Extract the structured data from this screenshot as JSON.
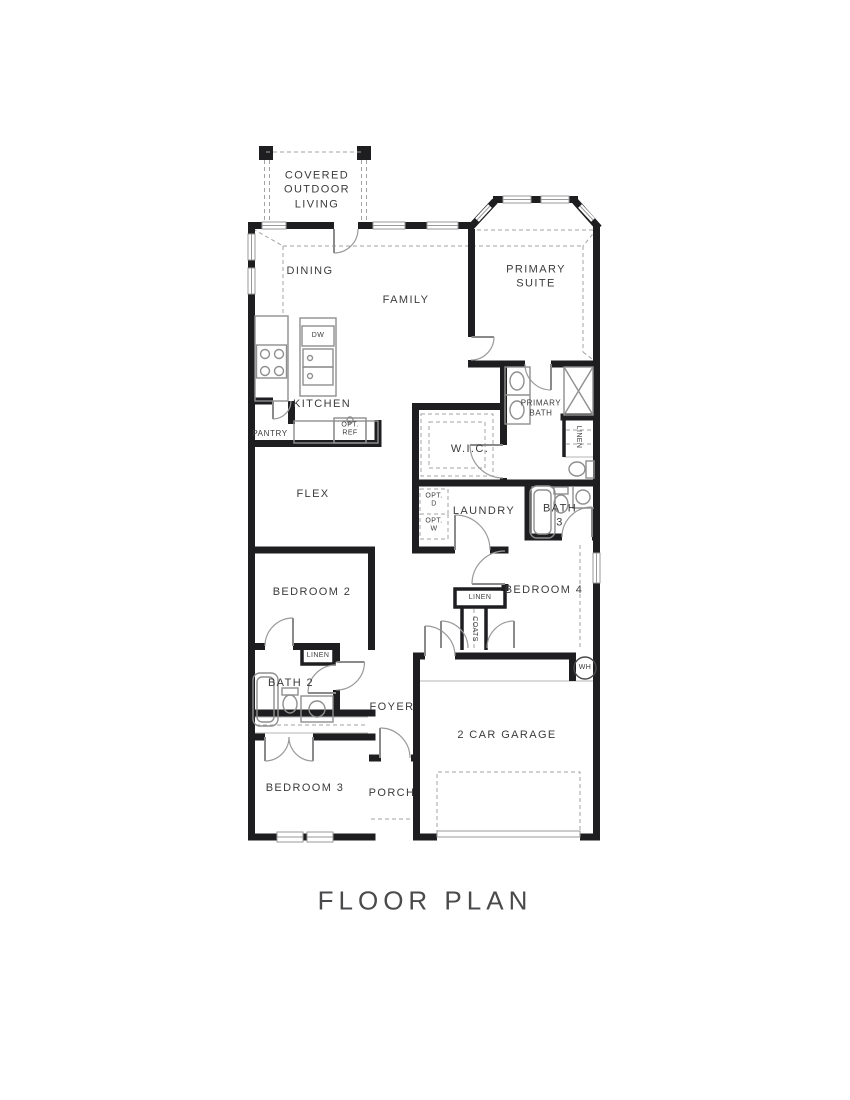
{
  "title": "FLOOR PLAN",
  "colors": {
    "wall": "#1e1e20",
    "fixture_line": "#8f8f8f",
    "dashed_line": "#a3a3a3",
    "text": "#3b3b3d"
  },
  "plan": {
    "rooms": {
      "covered_outdoor_living": "COVERED\nOUTDOOR\nLIVING",
      "dining": "DINING",
      "family": "FAMILY",
      "primary_suite": "PRIMARY\nSUITE",
      "kitchen": "KITCHEN",
      "pantry": "PANTRY",
      "wic": "W.I.C.",
      "primary_bath": "PRIMARY\nBATH",
      "flex": "FLEX",
      "laundry": "LAUNDRY",
      "bath3": "BATH\n3",
      "bedroom2": "BEDROOM 2",
      "bedroom4": "BEDROOM 4",
      "bath2": "BATH 2",
      "foyer": "FOYER",
      "bedroom3": "BEDROOM 3",
      "porch": "PORCH",
      "garage": "2 CAR GARAGE"
    },
    "features": {
      "dw": "DW",
      "opt_ref": "OPT.\nREF",
      "opt_d": "OPT.\nD",
      "opt_w": "OPT.\nW",
      "linen_primary": "LINEN",
      "linen_hall": "LINEN",
      "linen_bath2": "LINEN",
      "coats": "COATS",
      "wh": "WH"
    }
  }
}
